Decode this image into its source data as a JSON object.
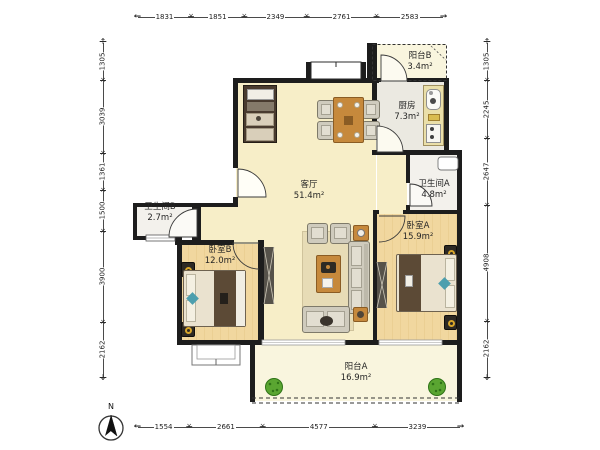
{
  "plan": {
    "rooms": [
      {
        "id": "living",
        "label": "客厅",
        "area": "51.4m²"
      },
      {
        "id": "kitchen",
        "label": "厨房",
        "area": "7.3m²"
      },
      {
        "id": "balcony_b",
        "label": "阳台B",
        "area": "3.4m²"
      },
      {
        "id": "bath_a",
        "label": "卫生间A",
        "area": "4.8m²"
      },
      {
        "id": "bath_b",
        "label": "卫生间B",
        "area": "2.7m²"
      },
      {
        "id": "bed_b",
        "label": "卧室B",
        "area": "12.0m²"
      },
      {
        "id": "bed_a",
        "label": "卧室A",
        "area": "15.9m²"
      },
      {
        "id": "balcony_a",
        "label": "阳台A",
        "area": "16.9m²"
      }
    ],
    "dimensions": {
      "top": [
        "1831",
        "1851",
        "2349",
        "2761",
        "2583"
      ],
      "bottom": [
        "1554",
        "2661",
        "4577",
        "3239"
      ],
      "left": [
        "1305",
        "3039",
        "1361",
        "1500",
        "3900",
        "2162"
      ],
      "right": [
        "1305",
        "2245",
        "2647",
        "4908",
        "2162"
      ]
    },
    "compass": {
      "label": "N"
    },
    "colors": {
      "wall": "#1d1d1d",
      "floor_living": "#f7eec8",
      "floor_wood": "#f1d79f",
      "floor_balcony": "#f9f5de",
      "floor_tile": "#f3f1ec",
      "furniture_wood": "#c6893c",
      "blanket_brown": "#5c4a36",
      "accent_teal": "#4d9fae",
      "plant_green": "#5aa531",
      "nightstand_ring": "#d8a62a"
    }
  }
}
